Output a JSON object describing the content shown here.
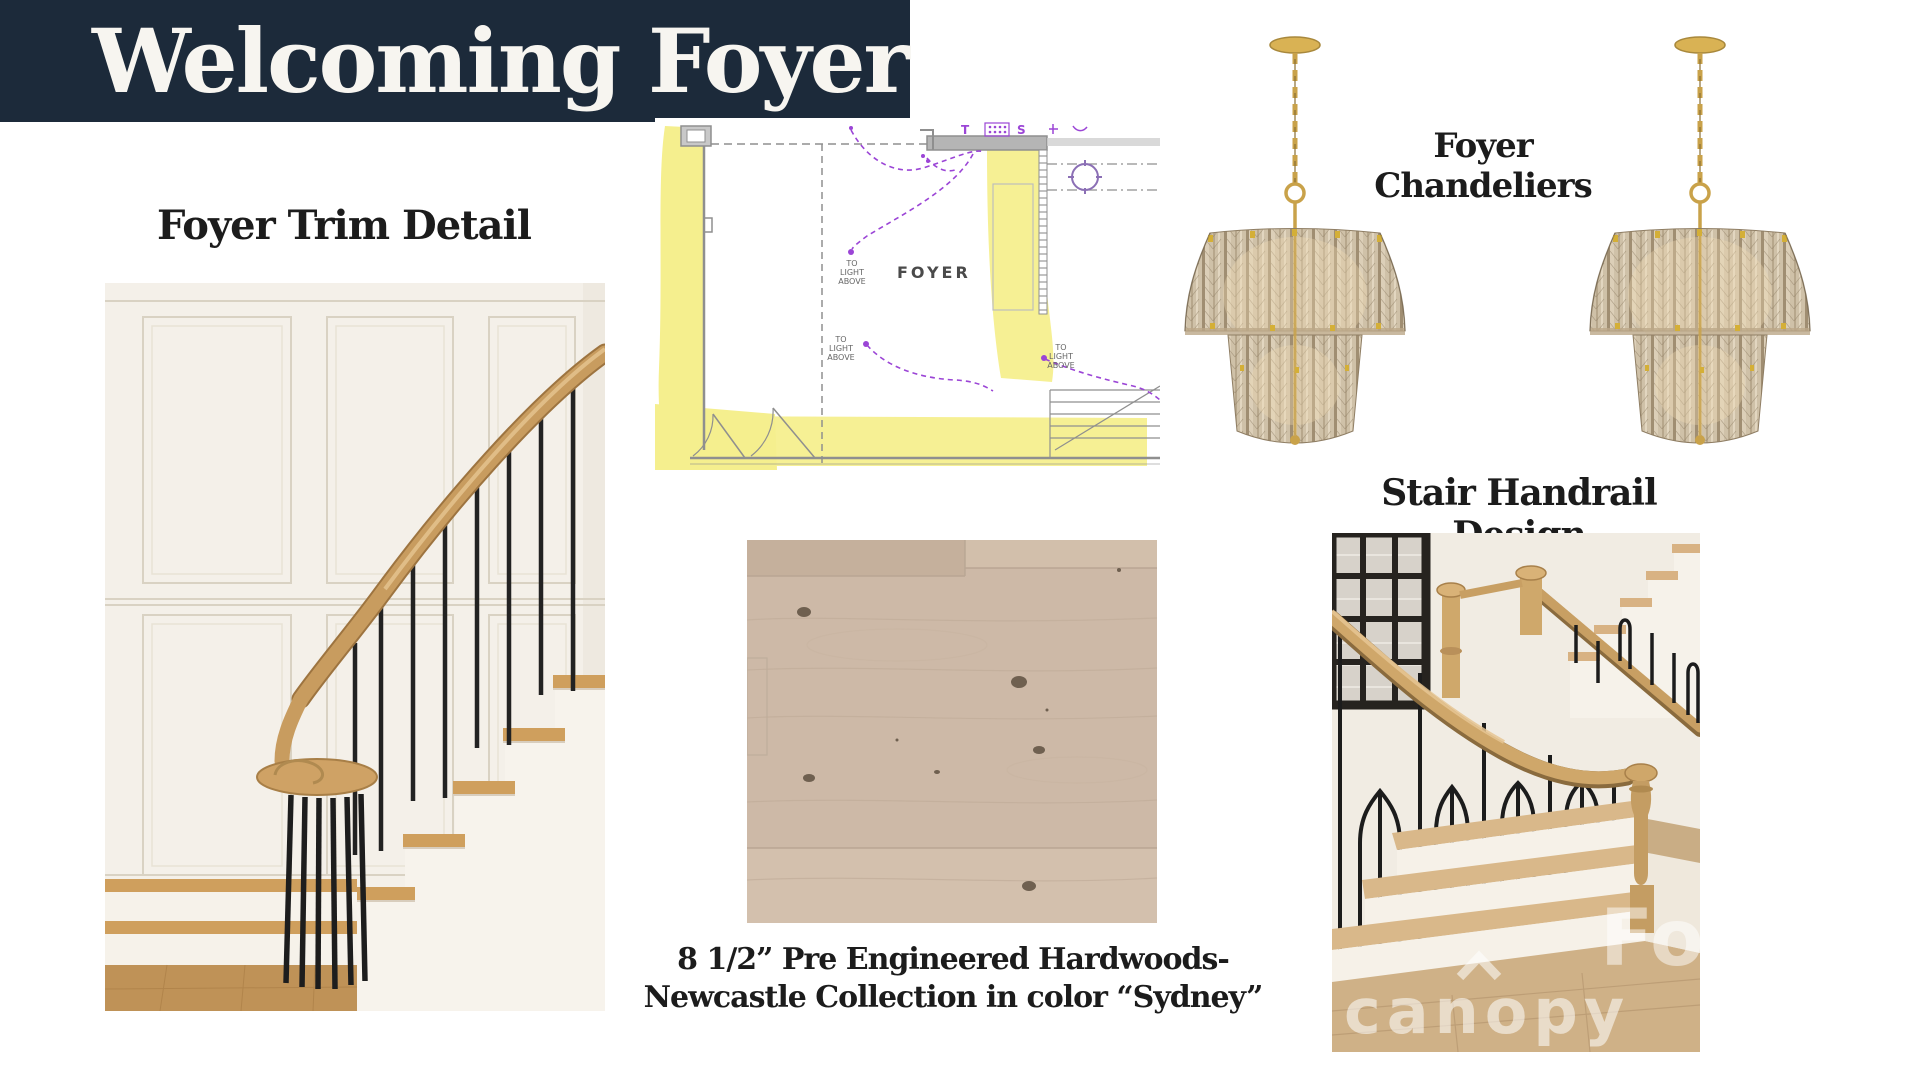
{
  "banner": {
    "title": "Welcoming Foyer"
  },
  "sections": {
    "trim": {
      "heading": "Foyer Trim Detail"
    },
    "chandeliers": {
      "heading_line1": "Foyer",
      "heading_line2": "Chandeliers"
    },
    "handrail": {
      "heading": "Stair Handrail Design"
    },
    "flooring": {
      "caption_line1": "8 1/2” Pre Engineered Hardwoods-",
      "caption_line2": "Newcastle Collection in color “Sydney”"
    }
  },
  "floor_plan": {
    "room_label": "FOYER",
    "light_note": {
      "l1": "TO",
      "l2": "LIGHT",
      "l3": "ABOVE"
    },
    "symbols": {
      "t": "T",
      "s": "S"
    }
  },
  "watermark": {
    "text": "canopy",
    "logo": "Fo"
  },
  "colors": {
    "banner_bg": "#1c2a3a",
    "banner_text": "#f7f5f0",
    "heading_text": "#1c1c1c",
    "plan_highlight": "#f5ef8e",
    "plan_wiring": "#9b45d6",
    "plan_wall": "#8f8f8f",
    "brass": "#c9a24a",
    "oak": "#c89c5f",
    "iron": "#202020"
  }
}
